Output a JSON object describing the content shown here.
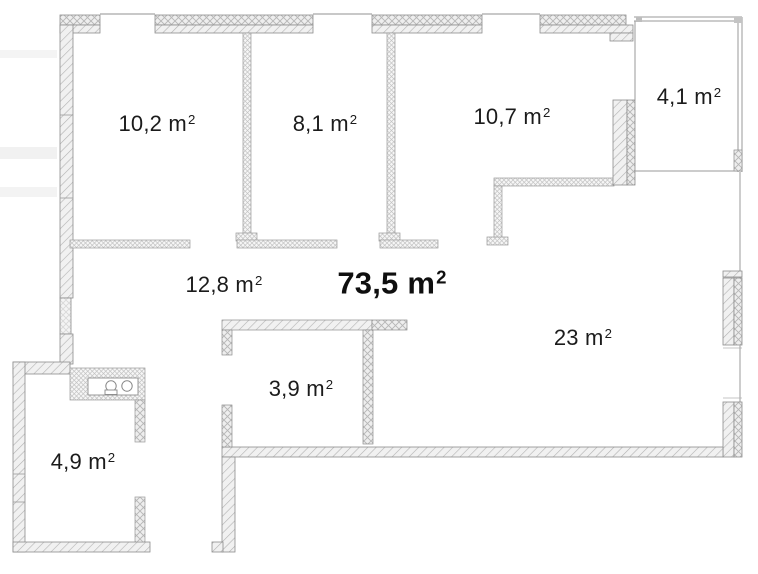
{
  "floorplan": {
    "total_area": {
      "value": "73,5",
      "unit": " m",
      "sup": "2"
    },
    "rooms": [
      {
        "name": "bedroom-1",
        "value": "10,2",
        "unit": " m",
        "sup": "2"
      },
      {
        "name": "bedroom-2",
        "value": "8,1",
        "unit": " m",
        "sup": "2"
      },
      {
        "name": "bedroom-3",
        "value": "10,7",
        "unit": " m",
        "sup": "2"
      },
      {
        "name": "balcony",
        "value": "4,1",
        "unit": " m",
        "sup": "2"
      },
      {
        "name": "hallway",
        "value": "12,8",
        "unit": " m",
        "sup": "2"
      },
      {
        "name": "living-room",
        "value": "23",
        "unit": " m",
        "sup": "2"
      },
      {
        "name": "storage",
        "value": "3,9",
        "unit": " m",
        "sup": "2"
      },
      {
        "name": "bathroom",
        "value": "4,9",
        "unit": " m",
        "sup": "2"
      }
    ],
    "colors": {
      "wall_outline": "#8d8d8d",
      "hatch": "#b4b4b4",
      "label_text": "#1b1b1b",
      "background": "#ffffff"
    }
  }
}
